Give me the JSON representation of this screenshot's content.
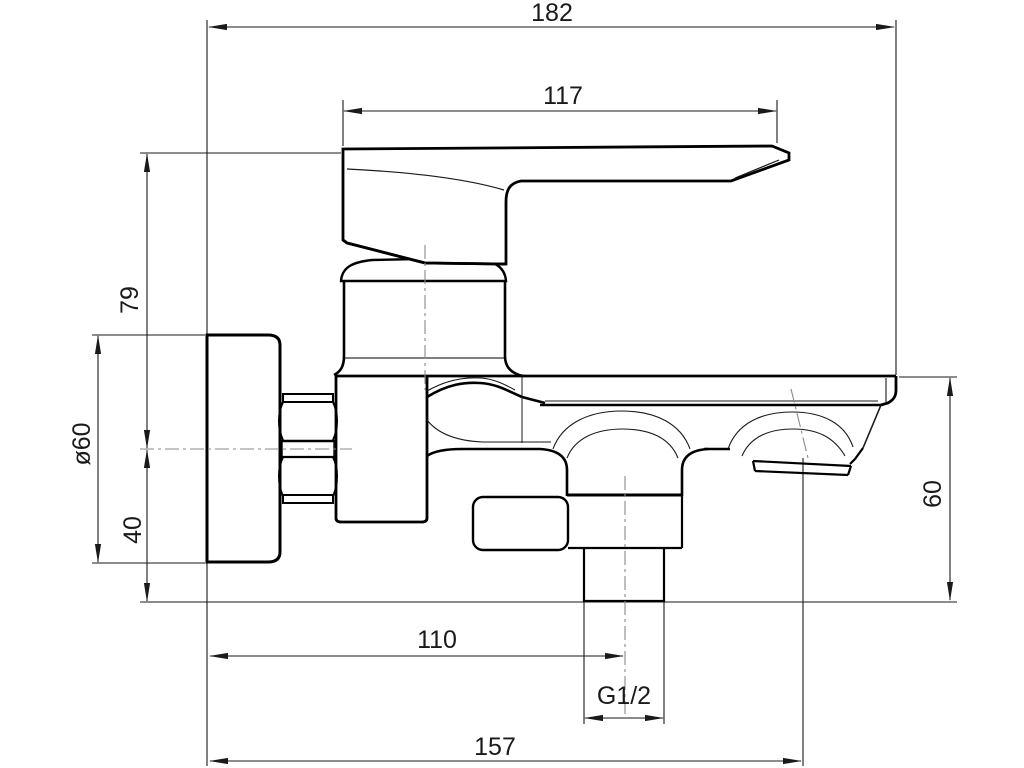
{
  "drawing": {
    "dimensions": {
      "overall_projection": "182",
      "handle_length": "117",
      "height_above_axis": "79",
      "flange_diameter": "ø60",
      "axis_to_body_bottom": "40",
      "spout_drop": "60",
      "axis_to_shower_outlet": "110",
      "outlet_thread": "G1/2",
      "axis_to_spout_tip": "157"
    },
    "colors": {
      "contour_line": "#000000",
      "thin_line": "#1a1a1a",
      "centerline": "#8a8a8a",
      "background": "#ffffff"
    }
  }
}
